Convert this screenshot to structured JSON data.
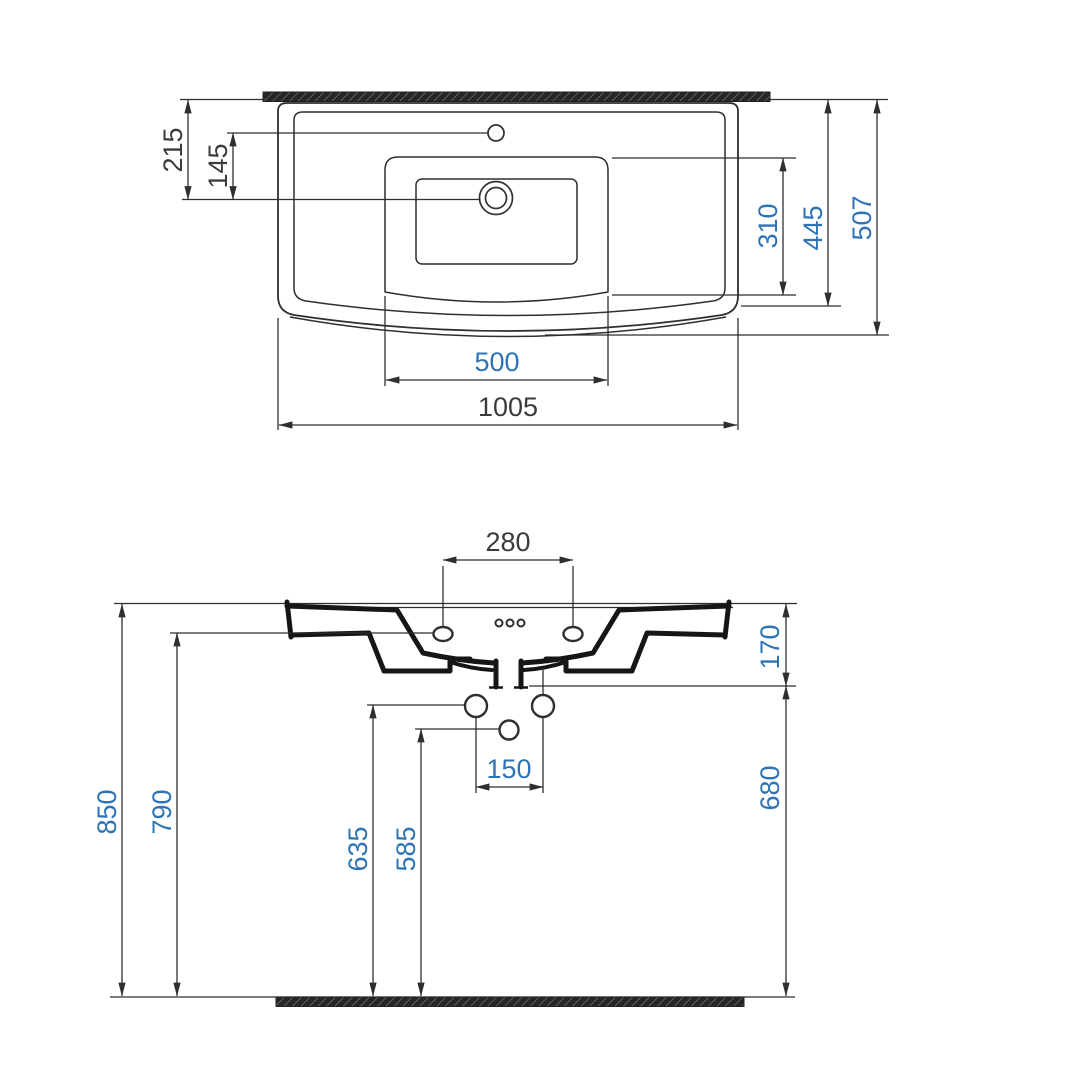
{
  "colors": {
    "background": "#ffffff",
    "line": "#2f2f2f",
    "profile": "#161616",
    "section_fill": "#262626",
    "section_slash": "#8a8a8a",
    "dim_black": "#3b3b3b",
    "dim_blue": "#2e74b5"
  },
  "top_view": {
    "dims": {
      "d215": "215",
      "d145": "145",
      "d310": "310",
      "d445": "445",
      "d507": "507",
      "d500": "500",
      "d1005": "1005"
    }
  },
  "front_view": {
    "dims": {
      "d280": "280",
      "d170": "170",
      "d680": "680",
      "d850": "850",
      "d790": "790",
      "d635": "635",
      "d585": "585",
      "d150": "150"
    }
  }
}
